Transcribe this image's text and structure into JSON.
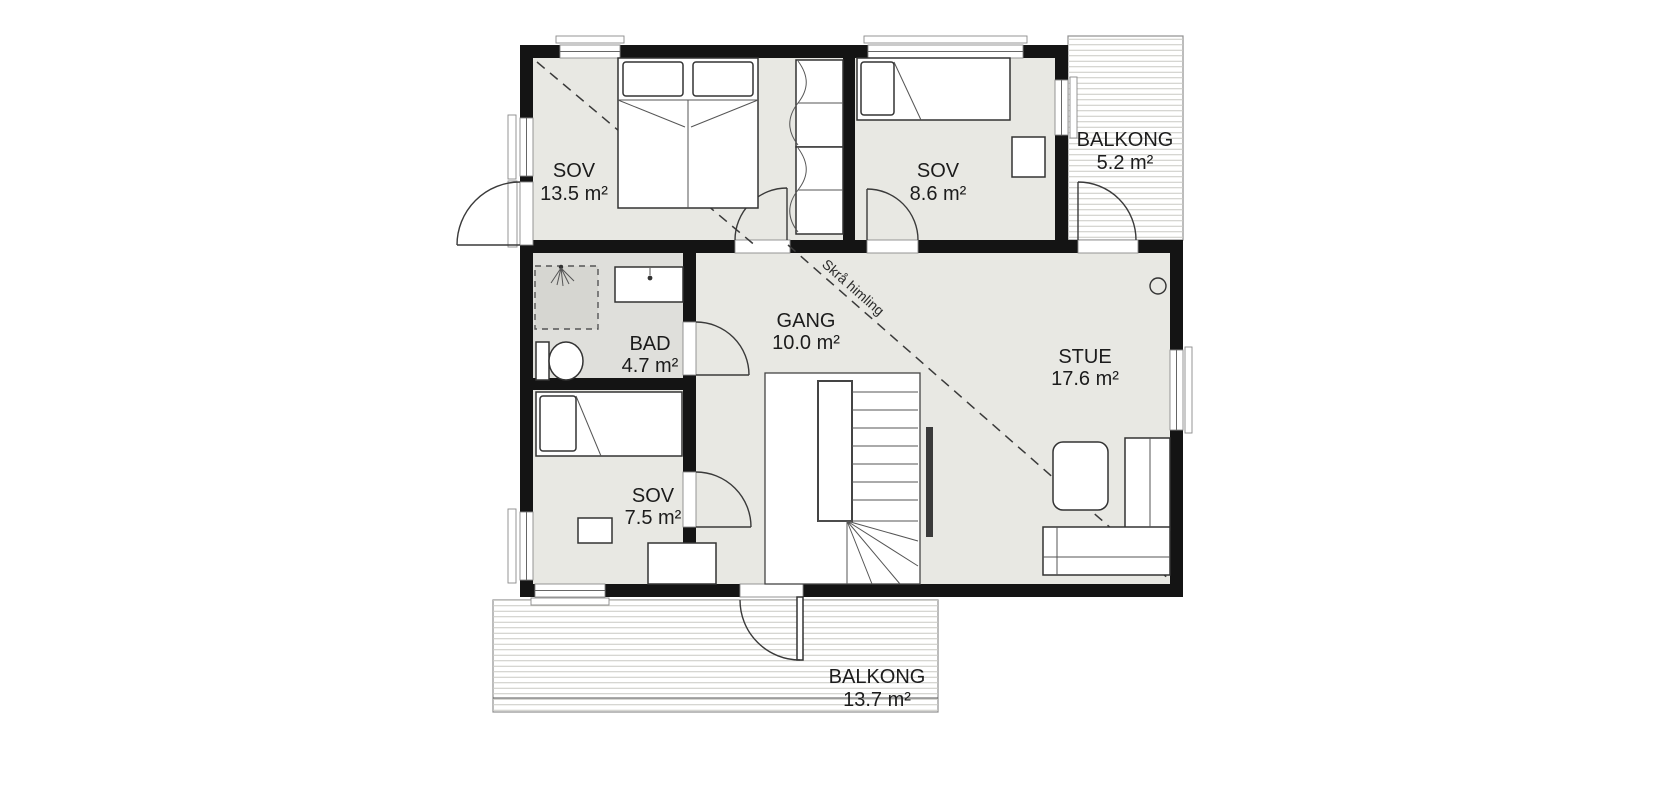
{
  "plan": {
    "rooms": [
      {
        "name": "SOV",
        "area": "13.5 m²"
      },
      {
        "name": "SOV",
        "area": "8.6 m²"
      },
      {
        "name": "BALKONG",
        "area": "5.2 m²"
      },
      {
        "name": "BAD",
        "area": "4.7 m²"
      },
      {
        "name": "GANG",
        "area": "10.0 m²"
      },
      {
        "name": "STUE",
        "area": "17.6 m²"
      },
      {
        "name": "SOV",
        "area": "7.5 m²"
      },
      {
        "name": "BALKONG",
        "area": "13.7 m²"
      }
    ],
    "annotation": {
      "sloped_ceiling": "Skrå himling"
    }
  },
  "colors": {
    "wall": "#141414",
    "floor": "#e8e8e3",
    "bathroom_floor": "#dfdfdb",
    "shower_floor": "#d6d6d1",
    "deck_line": "#c8c8c3",
    "outline": "#333333",
    "text": "#1c1c1c"
  }
}
